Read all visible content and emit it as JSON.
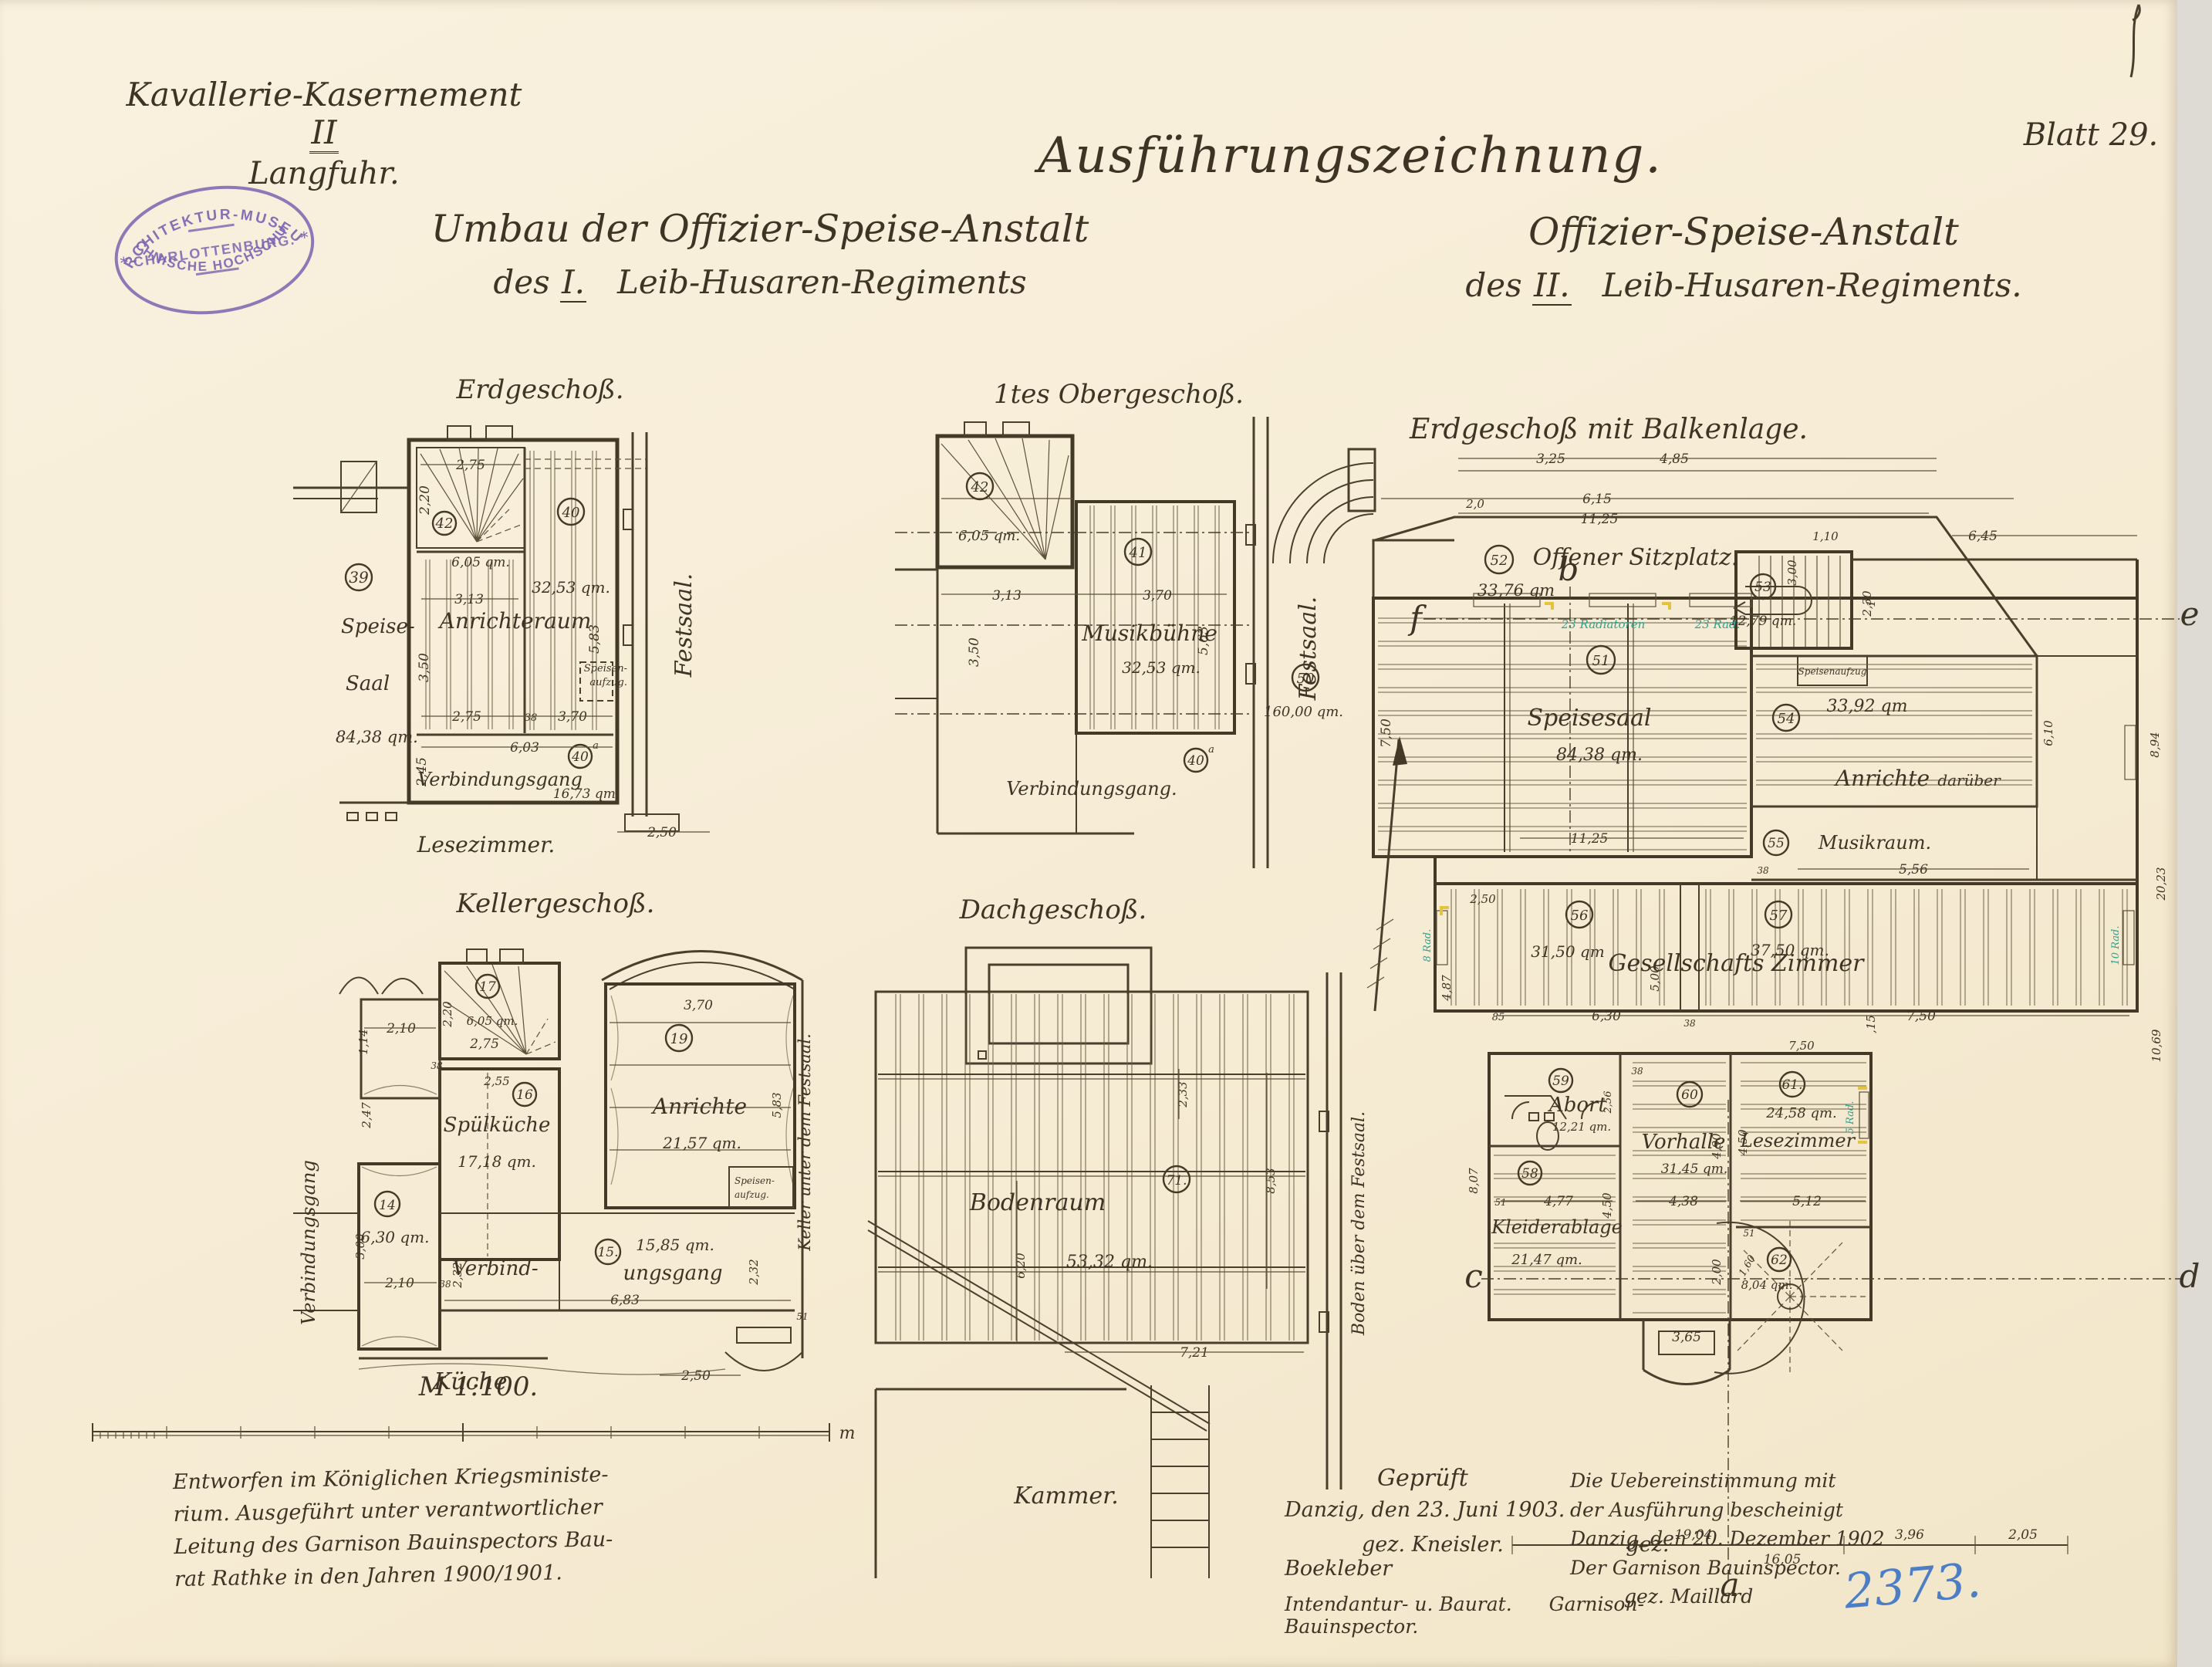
{
  "meta": {
    "sheet": "Blatt 29.",
    "catalog": "2373."
  },
  "header": {
    "site1a": "Kavallerie-Kasernement",
    "site1b": "II",
    "site2": "Langfuhr.",
    "stamp1": "ARCHITEKTUR-MUSEUM",
    "stamp2": "CHARLOTTENBURG.",
    "stamp3": "TECHNISCHE HOCHSCHULE.",
    "stamp_star": "*",
    "main_title": "Ausführungszeichnung.",
    "left1": "Umbau der Offizier-Speise-Anstalt",
    "left2a": "des",
    "left2b": "I.",
    "left2c": "Leib-Husaren-Regiments",
    "right1": "Offizier-Speise-Anstalt",
    "right2a": "des",
    "right2b": "II.",
    "right2c": "Leib-Husaren-Regiments."
  },
  "plans": {
    "eg": {
      "title": "Erdgeschoß.",
      "r39": "39",
      "r40": "40",
      "r40a": "40",
      "r40a_sup": "a",
      "r42": "42",
      "area42": "6,05 qm.",
      "area40": "32,53 qm.",
      "area40a": "16,73 qm.",
      "speise1": "Speise-",
      "speise2": "Saal",
      "speise_area": "84,38 qm.",
      "anrichteraum": "Anrichteraum",
      "verbindungsgang": "Verbindungsgang",
      "festsaal": "Festsaal.",
      "lesezimmer": "Lesezimmer.",
      "aufzug1": "Speisen-",
      "aufzug2": "aufzug.",
      "dims": [
        "2,75",
        "2,20",
        "3,13",
        "3,50",
        "2,75",
        "38",
        "3,70",
        "5,83",
        "6,03",
        "2,45",
        "2,50"
      ]
    },
    "og": {
      "title": "1tes Obergeschoß.",
      "r41": "41",
      "r42": "42",
      "r40a": "40",
      "r40a_sup": "a",
      "area42": "6,05 qm.",
      "musik": "Musikbühne",
      "area41": "32,53 qm.",
      "verbindungsgang": "Verbindungsgang.",
      "festsaal": "Festsaal.",
      "dims": [
        "3,13",
        "3,70",
        "3,50",
        "5,63"
      ]
    },
    "kg": {
      "title": "Kellergeschoß.",
      "r14": "14",
      "r15": "15.",
      "r16": "16",
      "r17": "17",
      "r19": "19",
      "area17": "6,05 qm.",
      "anrichte": "Anrichte",
      "area19": "21,57 qm.",
      "spuelkueche": "Spülküche",
      "area16": "17,18 qm.",
      "area14": "6,30 qm.",
      "verbind1": "Verbind-",
      "verbind2": "ungsgang",
      "area15": "15,85 qm.",
      "kueche": "Küche",
      "vleft": "Verbindungsgang",
      "vright": "Keller unter dem Festsaal.",
      "aufzug1": "Speisen-",
      "aufzug2": "aufzug.",
      "dims": [
        "2,10",
        "1,14",
        "38",
        "2,47",
        "2,20",
        "2,75",
        "2,55",
        "3,70",
        "5,83",
        "3,00",
        "2,10",
        "38",
        "2,32",
        "6,83",
        "2,32",
        "2,50",
        "51"
      ]
    },
    "dg": {
      "title": "Dachgeschoß.",
      "r71": "71.",
      "bodenraum": "Bodenraum",
      "area": "53,32 qm.",
      "kammer": "Kammer.",
      "vright": "Boden über dem Festsaal.",
      "dims": [
        "2,33",
        "8,53",
        "6,20",
        "7,21"
      ]
    },
    "balken": {
      "title": "Erdgeschoß mit Balkenlage.",
      "r50": "50",
      "area50": "160,00 qm.",
      "r51": "51",
      "name51": "Speisesaal",
      "area51": "84,38 qm.",
      "r52": "52",
      "name52": "Offener Sitzplatz.",
      "area52": "33,76 qm",
      "r53": "53",
      "area53": "12,79 qm.",
      "r54": "54",
      "name54a": "Anrichte",
      "name54b": "darüber",
      "area54": "33,92 qm",
      "r55": "55",
      "name55": "Musikraum.",
      "r56": "56",
      "area56": "31,50 qm",
      "r57": "57",
      "area57": "37,50 qm.",
      "r58": "58",
      "name58": "Kleiderablage",
      "area58": "21,47 qm.",
      "r59": "59",
      "name59": "Abort",
      "area59": "12,21 qm.",
      "r60": "60",
      "name60": "Vorhalle",
      "area60": "31,45 qm.",
      "r61": "61.",
      "name61": "Lesezimmer",
      "area61": "24,58 qm.",
      "r62": "62",
      "area62": "8,04 qm.",
      "gesellschaft": "Gesellschafts Zimmer",
      "speisenaufzug": "Speisenaufzug",
      "rad_long": "23 Radiatoren",
      "rad_short": "23 Rad.",
      "rad8": "8 Rad.",
      "rad10": "10 Rad.",
      "rad5": "5 Rad.",
      "sec_a": "a",
      "sec_b": "b",
      "sec_c": "c",
      "sec_d": "d",
      "sec_e": "e",
      "sec_f": "f",
      "dims": [
        "3,25",
        "4,85",
        "2,0",
        "6,15",
        "11,25",
        "3,00",
        "1,10",
        "1,15",
        "6,45",
        "2,30",
        "7,50",
        "11,25",
        "6,10",
        "5,56",
        "38",
        "2,50",
        "4,87",
        "85",
        "6,30",
        "38",
        "7,50",
        "5,00",
        "2,56",
        "4,77",
        "51",
        "4,50",
        "8,07",
        "4,38",
        "4,90",
        "7,50",
        "5,12",
        "4,50",
        "2,00",
        "1,60",
        "51",
        "3,65",
        "19,04",
        "16,05",
        "3,96",
        "2,05",
        "8,94",
        "20,23",
        "10,69",
        "38"
      ]
    }
  },
  "scale": {
    "label": "M 1:100.",
    "unit": "m"
  },
  "footer": {
    "left": [
      "Entworfen im Königlichen Kriegsministe-",
      "rium. Ausgeführt unter verantwortlicher",
      "Leitung des Garnison Bauinspectors Bau-",
      "rat Rathke in den Jahren 1900/1901."
    ],
    "center_title": "Geprüft",
    "center_date": "Danzig, den 23. Juni 1903.",
    "sig1": "gez. Kneisler.",
    "sig2": "gez. Boekleber",
    "role1": "Intendantur- u. Baurat.",
    "role2": "Garnison- Bauinspector.",
    "right": [
      "Die Uebereinstimmung mit",
      "der Ausführung bescheinigt",
      "Danzig, den 20. Dezember 1902",
      "Der Garnison Bauinspector.",
      "gez. Maillard"
    ]
  }
}
